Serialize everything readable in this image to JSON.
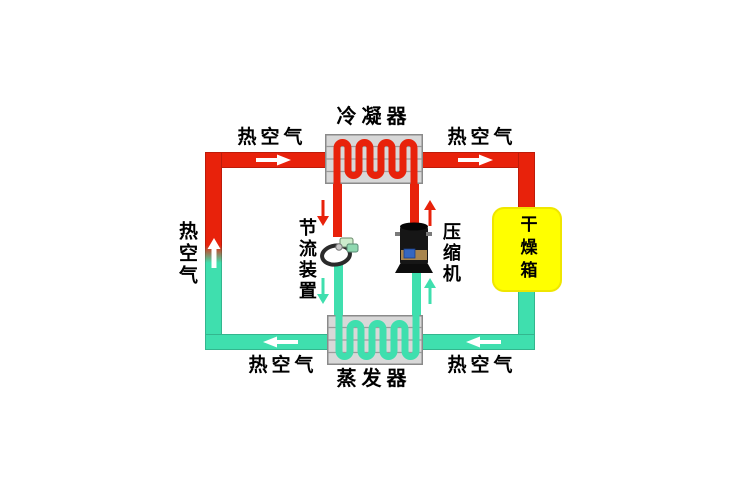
{
  "figure": {
    "type": "heat-pump drying system diagram",
    "components": {
      "condenser": {
        "label": "冷凝器"
      },
      "evaporator": {
        "label": "蒸发器"
      },
      "throttle_device": {
        "label": "节流装置"
      },
      "compressor": {
        "label": "压缩机"
      },
      "drying_box": {
        "label": "干燥箱"
      }
    },
    "air_flow_labels": {
      "top_left": "热空气",
      "top_right": "热空气",
      "left_side": "热空气",
      "bottom_left": "热空气",
      "bottom_right": "热空气"
    },
    "colors": {
      "hot_pipe": "#e8220b",
      "cold_pipe": "#3fdfae",
      "drying_box_fill": "#ffff00",
      "exchanger_fill": "#d8d8d8",
      "exchanger_border": "#8a8a8a",
      "flow_arrow": "#ffffff",
      "label_text": "#000000"
    }
  }
}
